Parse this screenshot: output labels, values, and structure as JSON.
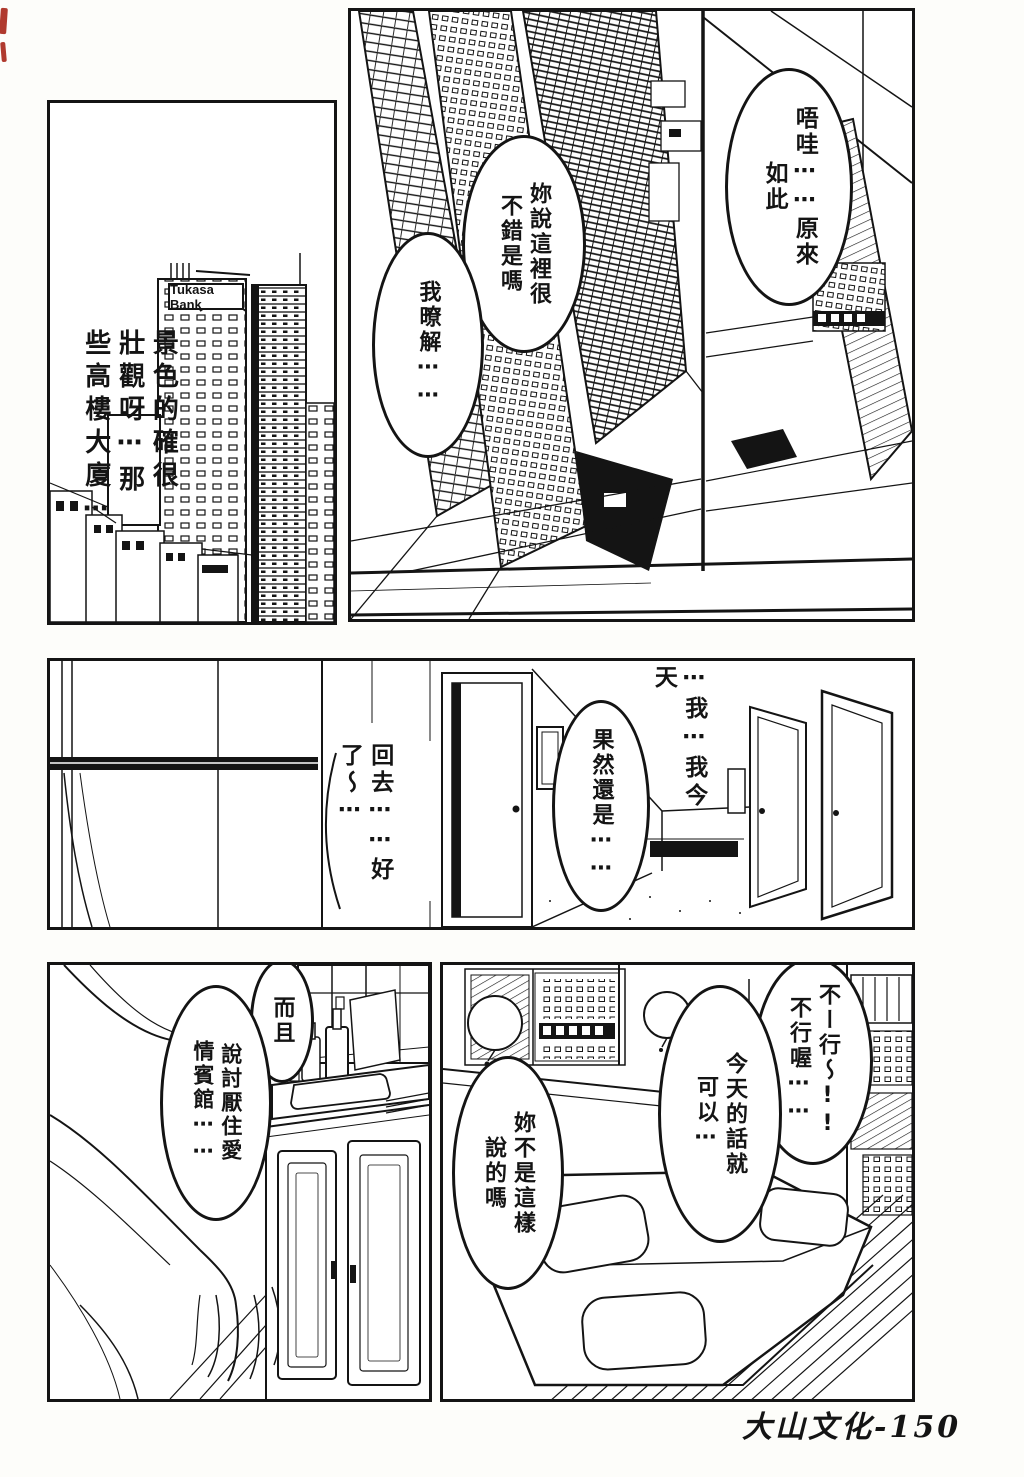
{
  "page": {
    "kind": "manga-page",
    "footer": "大山文化-150",
    "ink_color": "#141414",
    "paper_color": "#ffffff",
    "artifact_color": "#b03a2e"
  },
  "top_left_panel": {
    "building_sign": "Tukasa Bank",
    "narration": "景色的確很\n壯觀呀⋯那\n些高樓大廈⋯"
  },
  "top_right_panel": {
    "bubble_you_said": "妳說這裡很\n不錯是嗎",
    "bubble_i_see": "我暸解⋯⋯",
    "bubble_wow": "唔哇⋯⋯原來\n如此"
  },
  "middle_panel": {
    "text_today_i": "⋯我⋯我今\n天",
    "bubble_after_all": "果然還是⋯⋯",
    "text_go_home": "回去⋯⋯好\n了～⋯"
  },
  "bottom_left_panel": {
    "bubble_moreover": "而且",
    "bubble_hotel": "說討厭住愛\n情賓館⋯⋯"
  },
  "bottom_right_panel": {
    "bubble_no_way": "不ー行～!!\n不行喔⋯⋯",
    "bubble_today_ok": "今天的話就\n可以⋯",
    "bubble_you_said_so": "妳不是這樣\n說的嗎"
  }
}
